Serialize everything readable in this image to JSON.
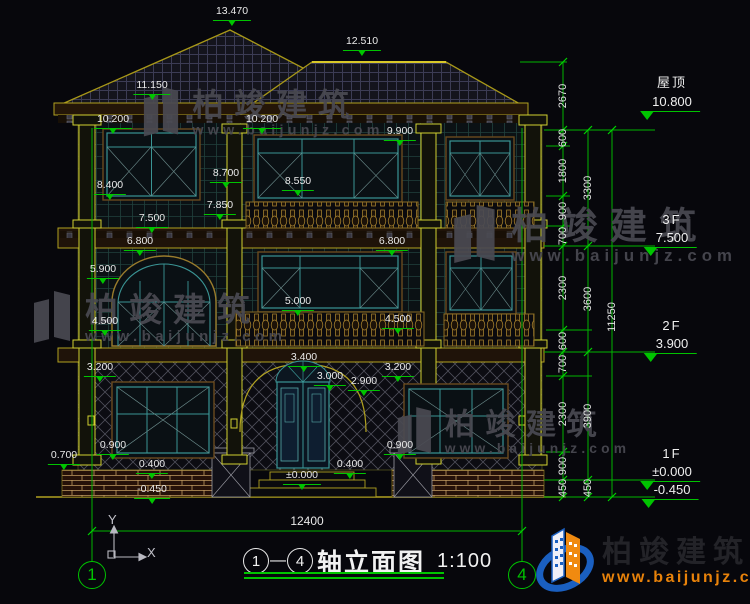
{
  "drawing": {
    "title_axis_from": "1",
    "title_axis_to": "4",
    "title_dash": "—",
    "title_name": "轴立面图",
    "title_scale": "1:100"
  },
  "bottom_dimension": {
    "value": "12400",
    "x": 307,
    "y": 514
  },
  "ucs": {
    "y_label": "Y",
    "x_label": "X"
  },
  "axis_bubbles": [
    {
      "label": "1",
      "x": 92,
      "y": 575
    },
    {
      "label": "4",
      "x": 522,
      "y": 575
    }
  ],
  "floor_labels": [
    {
      "name": "屋顶",
      "value": "10.800",
      "x": 672,
      "y": 72
    },
    {
      "name": "3F",
      "value": "7.500",
      "x": 672,
      "y": 212
    },
    {
      "name": "2F",
      "value": "3.900",
      "x": 672,
      "y": 318
    },
    {
      "name": "1F",
      "value": "±0.000",
      "x": 672,
      "y": 446
    },
    {
      "name": "",
      "value": "-0.450",
      "x": 672,
      "y": 481
    }
  ],
  "elevation_markers": [
    {
      "v": "13.470",
      "x": 232,
      "y": 6
    },
    {
      "v": "12.510",
      "x": 362,
      "y": 36
    },
    {
      "v": "11.150",
      "x": 152,
      "y": 80
    },
    {
      "v": "10.200",
      "x": 113,
      "y": 114
    },
    {
      "v": "10.200",
      "x": 262,
      "y": 114
    },
    {
      "v": "9.900",
      "x": 400,
      "y": 126
    },
    {
      "v": "8.400",
      "x": 110,
      "y": 180
    },
    {
      "v": "8.700",
      "x": 226,
      "y": 168
    },
    {
      "v": "8.550",
      "x": 298,
      "y": 176
    },
    {
      "v": "7.850",
      "x": 220,
      "y": 200
    },
    {
      "v": "7.500",
      "x": 152,
      "y": 213
    },
    {
      "v": "6.800",
      "x": 140,
      "y": 236
    },
    {
      "v": "6.800",
      "x": 392,
      "y": 236
    },
    {
      "v": "5.900",
      "x": 103,
      "y": 264
    },
    {
      "v": "5.000",
      "x": 298,
      "y": 296
    },
    {
      "v": "4.500",
      "x": 105,
      "y": 316
    },
    {
      "v": "4.500",
      "x": 398,
      "y": 314
    },
    {
      "v": "3.400",
      "x": 304,
      "y": 352
    },
    {
      "v": "3.200",
      "x": 100,
      "y": 362
    },
    {
      "v": "3.200",
      "x": 398,
      "y": 362
    },
    {
      "v": "3.000",
      "x": 330,
      "y": 371
    },
    {
      "v": "2.900",
      "x": 364,
      "y": 376
    },
    {
      "v": "0.900",
      "x": 113,
      "y": 440
    },
    {
      "v": "0.900",
      "x": 400,
      "y": 440
    },
    {
      "v": "0.700",
      "x": 64,
      "y": 450
    },
    {
      "v": "0.400",
      "x": 152,
      "y": 459
    },
    {
      "v": "0.400",
      "x": 350,
      "y": 459
    },
    {
      "v": "±0.000",
      "x": 302,
      "y": 470
    },
    {
      "v": "-0.450",
      "x": 152,
      "y": 484
    }
  ],
  "dim_chains": [
    {
      "x": 563,
      "labels": [
        {
          "v": "2670",
          "y": 96
        },
        {
          "v": "600",
          "y": 138
        },
        {
          "v": "1800",
          "y": 171
        },
        {
          "v": "900",
          "y": 211
        },
        {
          "v": "700",
          "y": 236
        },
        {
          "v": "2300",
          "y": 288
        },
        {
          "v": "600",
          "y": 341
        },
        {
          "v": "700",
          "y": 364
        },
        {
          "v": "2300",
          "y": 414
        },
        {
          "v": "900",
          "y": 466
        },
        {
          "v": "450",
          "y": 488
        }
      ]
    },
    {
      "x": 588,
      "labels": [
        {
          "v": "3300",
          "y": 188
        },
        {
          "v": "3600",
          "y": 299
        },
        {
          "v": "3900",
          "y": 416
        },
        {
          "v": "450",
          "y": 488
        }
      ]
    },
    {
      "x": 612,
      "labels": [
        {
          "v": "11250",
          "y": 317
        }
      ]
    }
  ],
  "watermark": {
    "text": "柏竣建筑",
    "url": "www.baijunjz.com",
    "instances": [
      {
        "x": 142,
        "y": 88,
        "s": 0.95
      },
      {
        "x": 32,
        "y": 292,
        "s": 1.0
      },
      {
        "x": 452,
        "y": 206,
        "s": 1.12
      },
      {
        "x": 396,
        "y": 408,
        "s": 0.92
      }
    ]
  },
  "brand": {
    "text": "柏竣建筑",
    "url": "www.baijunjz.com"
  },
  "colors": {
    "background": "#07070c",
    "dimension_green": "#00c400",
    "linework_yellow": "#b0a020",
    "window_teal": "#3a9494",
    "text_white": "#e9e9e9",
    "watermark_gray": "#4a4a52",
    "brand_blue": "#1a5fc0",
    "brand_orange": "#f08a10"
  }
}
